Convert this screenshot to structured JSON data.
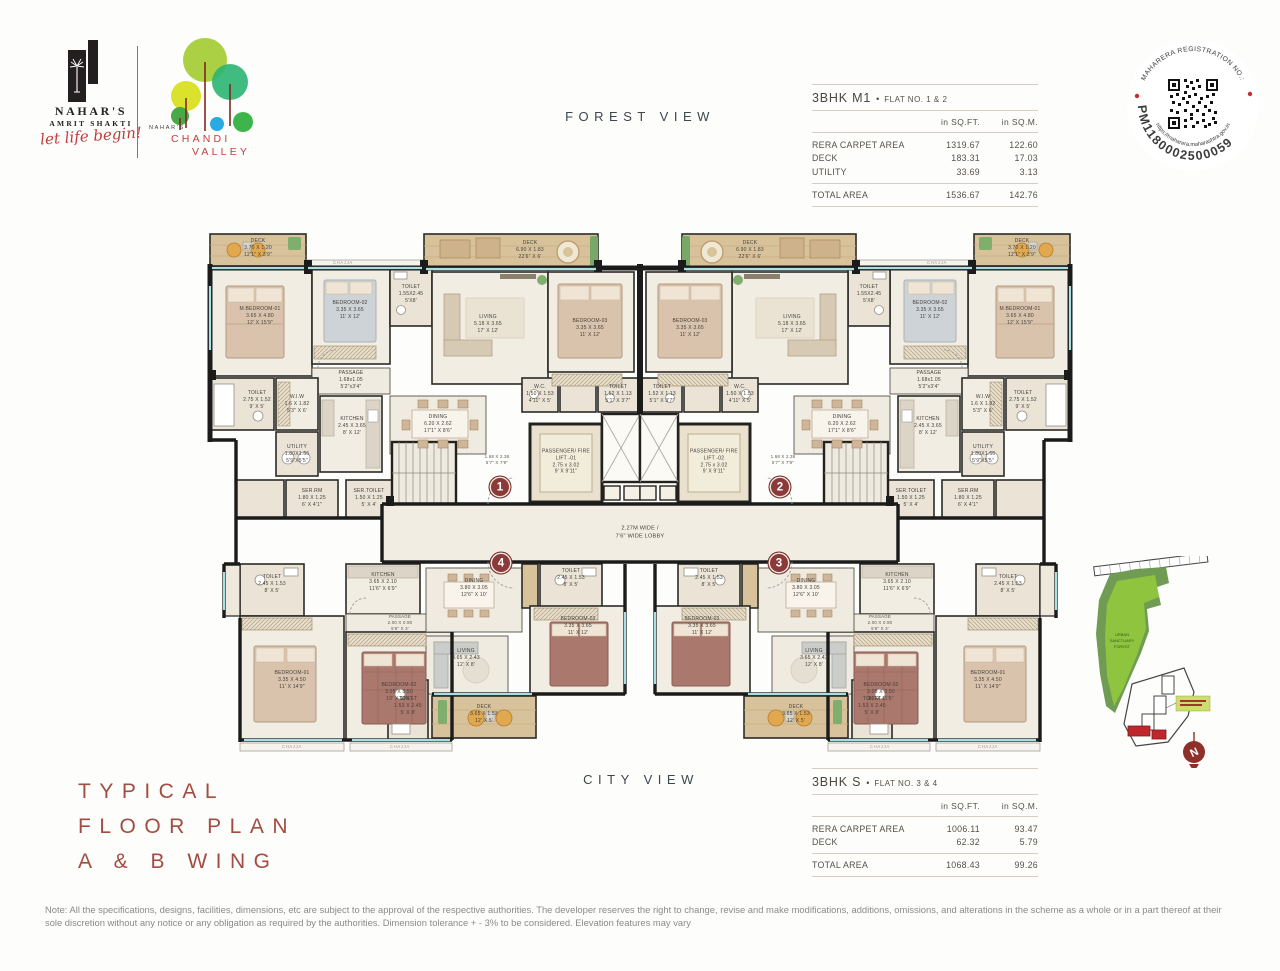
{
  "brand": {
    "name": "NAHAR'S",
    "sub": "AMRIT SHAKTI",
    "tagline": "let life begin!",
    "project_prefix": "NAHAR'S",
    "project_line1": "CHANDI",
    "project_line2": "VALLEY"
  },
  "views": {
    "top": "FOREST VIEW",
    "bottom": "CITY VIEW"
  },
  "plan_title": {
    "line1": "TYPICAL",
    "line2": "FLOOR PLAN",
    "line3": "A & B WING"
  },
  "rera_stamp": {
    "arc_top": "MAHARERA REGISTRATION NO.:",
    "number": "PM1180002500059",
    "arc_bottom": "https://maharera.maharashtra.gov.in"
  },
  "tables": [
    {
      "name": "3BHK M1",
      "sep": "•",
      "flats": "FLAT NO. 1 & 2",
      "col1": "in SQ.FT.",
      "col2": "in SQ.M.",
      "rows": [
        {
          "label": "RERA CARPET AREA",
          "sqft": "1319.67",
          "sqm": "122.60"
        },
        {
          "label": "DECK",
          "sqft": "183.31",
          "sqm": "17.03"
        },
        {
          "label": "UTILITY",
          "sqft": "33.69",
          "sqm": "3.13"
        }
      ],
      "total": {
        "label": "TOTAL AREA",
        "sqft": "1536.67",
        "sqm": "142.76"
      }
    },
    {
      "name": "3BHK S",
      "sep": "•",
      "flats": "FLAT NO. 3 & 4",
      "col1": "in SQ.FT.",
      "col2": "in SQ.M.",
      "rows": [
        {
          "label": "RERA CARPET AREA",
          "sqft": "1006.11",
          "sqm": "93.47"
        },
        {
          "label": "DECK",
          "sqft": "62.32",
          "sqm": "5.79"
        }
      ],
      "total": {
        "label": "TOTAL AREA",
        "sqft": "1068.43",
        "sqm": "99.26"
      }
    }
  ],
  "note": "Note: All the specifications, designs, facilities, dimensions, etc are subject to the approval of the respective authorities. The developer reserves the right to change, revise and make modifications, additions, omissions, and alterations in the scheme as a whole or in a part thereof at their sole discretion without any notice or any obligation as required by the authorities. Dimension tolerance + - 3% to be considered. Elevation features may vary",
  "plan": {
    "lobby": "2.27M WIDE /\n7'6\" WIDE LOBBY",
    "chajja": "CHAJJA",
    "units": {
      "u1": "1",
      "u2": "2",
      "u3": "3",
      "u4": "4"
    },
    "rooms": {
      "deck_corner": "DECK\n3.70 X 1.20\n12'1\" X 3'9\"",
      "deck_top": "DECK\n6.90 X 1.83\n22'6\" X 6'",
      "m_bedroom_01": "M.BEDROOM-01\n3.65 X 4.80\n12' X 15'9\"",
      "bedroom_02": "BEDROOM-02\n3.35 X 3.65\n11' X 12'",
      "bedroom_03": "BEDROOM-03\n3.35 X 3.65\n11' X 12'",
      "toilet_a": "TOILET\n1.55X2.45\n5'X8'",
      "living": "LIVING\n5.18 X 3.65\n17' X 12'",
      "toilet_c": "TOILET\n1.52 X 1.13\n5'1\" X 3'7\"",
      "wc": "W.C.\n1.50 X 1.53\n4'11\" X 5'",
      "passage": "PASSAGE\n1.68x1.05\n5'2\"x3'4\"",
      "toilet_b": "TOILET\n2.75 X 1.52\n9' X 5'",
      "wiw": "W.I.W\n1.6 X 1.82\n5'3\" X 6'",
      "kitchen": "KITCHEN\n2.45 X 3.65\n8' X 12'",
      "utility": "UTILITY\n1.80X1.66\n5'9\"X5'5\"",
      "ser_rm": "SER.RM\n1.80 X 1.25\n6' X 4'1\"",
      "ser_toilet": "SER.TOILET\n1.50 X 1.25\n5' X 4'",
      "dining": "DINING\n6.20 X 2.62\n17'1\" X 8'6\"",
      "lift1": "PASSENGER/ FIRE\nLIFT -01\n2.75 x 3.02\n9' X 9'11\"",
      "lift2": "PASSENGER/ FIRE\nLIFT -02\n2.75 x 3.02\n9' X 9'11\"",
      "dim_corner": "1.68 X 2.38\n5'7\" X 7'9\"",
      "kitchen_s": "KITCHEN\n3.65 X 2.10\n11'6\" X 6'9\"",
      "passage_s": "PASSAGE\n2.00 X 0.90\n6'6\" X 3'",
      "bedroom_01s": "BEDROOM-01\n3.35 X 4.50\n11' X 14'9\"",
      "bedroom_02s": "BEDROOM-02\n3.05 X 3.50\n10' X 11'6\"",
      "bedroom_03s": "BEDROOM-03\n3.35 X 3.65\n11' X 12'",
      "dining_s": "DINING\n3.80 X 3.05\n12'6\" X 10'",
      "toilet_s1": "TOILET\n2.45 X 1.53\n8' X 5'",
      "living_s": "LIVING\n3.65 X 2.43\n12' X 8'",
      "deck_s": "DECK\n3.65 X 1.53\n12' X 5'",
      "toilet_s2": "TOILET\n1.53 X 2.45\n5' X 8'"
    }
  },
  "site_map": {
    "forest": {
      "l1": "URBAN",
      "l2": "SANCTUARY",
      "l3": "FOREST"
    },
    "north": "N"
  }
}
